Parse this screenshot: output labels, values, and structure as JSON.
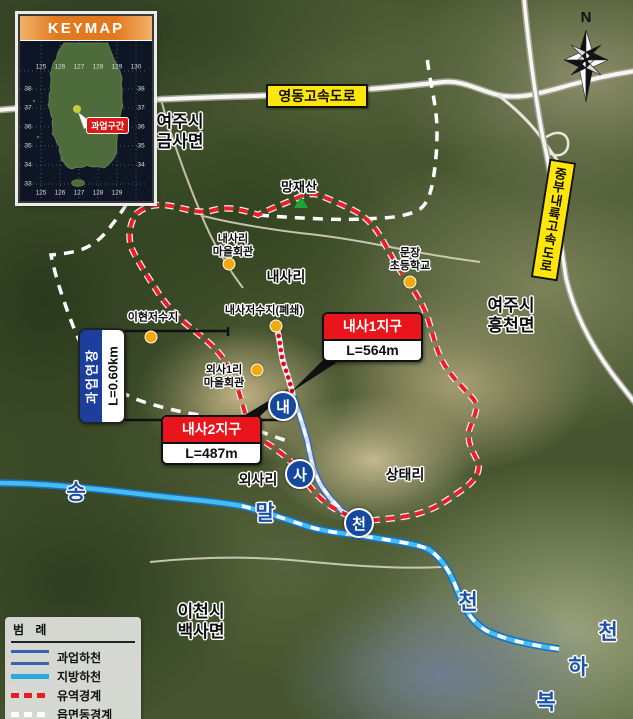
{
  "keymap": {
    "title": "KEYMAP",
    "marker_label": "과업구간",
    "grid_top": [
      "125",
      "126",
      "127",
      "128",
      "129",
      "130"
    ],
    "grid_left": [
      "38",
      "37",
      "36",
      "35",
      "34",
      "33"
    ],
    "grid_right": [
      "38",
      "37",
      "36",
      "35",
      "34"
    ],
    "grid_bottom": [
      "125",
      "126",
      "127",
      "128",
      "129"
    ]
  },
  "compass": {
    "north_label": "N"
  },
  "roads": {
    "yeongdong_label": "영동고속도로",
    "jungbu_label": "중부내륙고속도로"
  },
  "places": {
    "yeoju_geumsa": "여주시\n금사면",
    "yeoju_heungcheon": "여주시\n흥천면",
    "icheon_baeksa": "이천시\n백사면",
    "mangjaesan": "망재산",
    "naesari": "내사리",
    "oesari": "외사리",
    "sangdaeri": "상태리",
    "naesari_hall": "내사리\n마을회관",
    "oesa1ri_hall": "외사1리\n마을회관",
    "munjang_school": "문장\n초등학교",
    "ihyeon_reservoir": "이현저수지",
    "naesa_reservoir": "내사저수지(폐쇄)"
  },
  "districts": {
    "naesa1": {
      "name": "내사1지구",
      "length": "L=564m"
    },
    "naesa2": {
      "name": "내사2지구",
      "length": "L=487m"
    }
  },
  "extent": {
    "label": "과업연장",
    "length": "L=0.60km"
  },
  "stream_badges": [
    "내",
    "사",
    "천"
  ],
  "stream_text": {
    "song": "송",
    "mal": "말",
    "cheon_a": "천",
    "cheon_b": "천",
    "ha": "하",
    "bok": "복"
  },
  "legend": {
    "title": "범 례",
    "items": [
      {
        "label": "과업하천"
      },
      {
        "label": "지방하천"
      },
      {
        "label": "유역경계"
      },
      {
        "label": "읍면동경계"
      }
    ]
  },
  "colors": {
    "district_red": "#e8151c",
    "highway_yellow": "#ffe60a",
    "badge_navy": "#15499c",
    "stream_cyan": "#29aadf",
    "project_stream_blue": "#3a62b0",
    "watershed_red": "#ee1c25",
    "admin_boundary_white": "#ffffff",
    "extent_blue": "#1c3f9e",
    "poi_orange": "#f6a90a",
    "keymap_orange": "#e0791f",
    "mountain_green": "#1ea33c"
  }
}
